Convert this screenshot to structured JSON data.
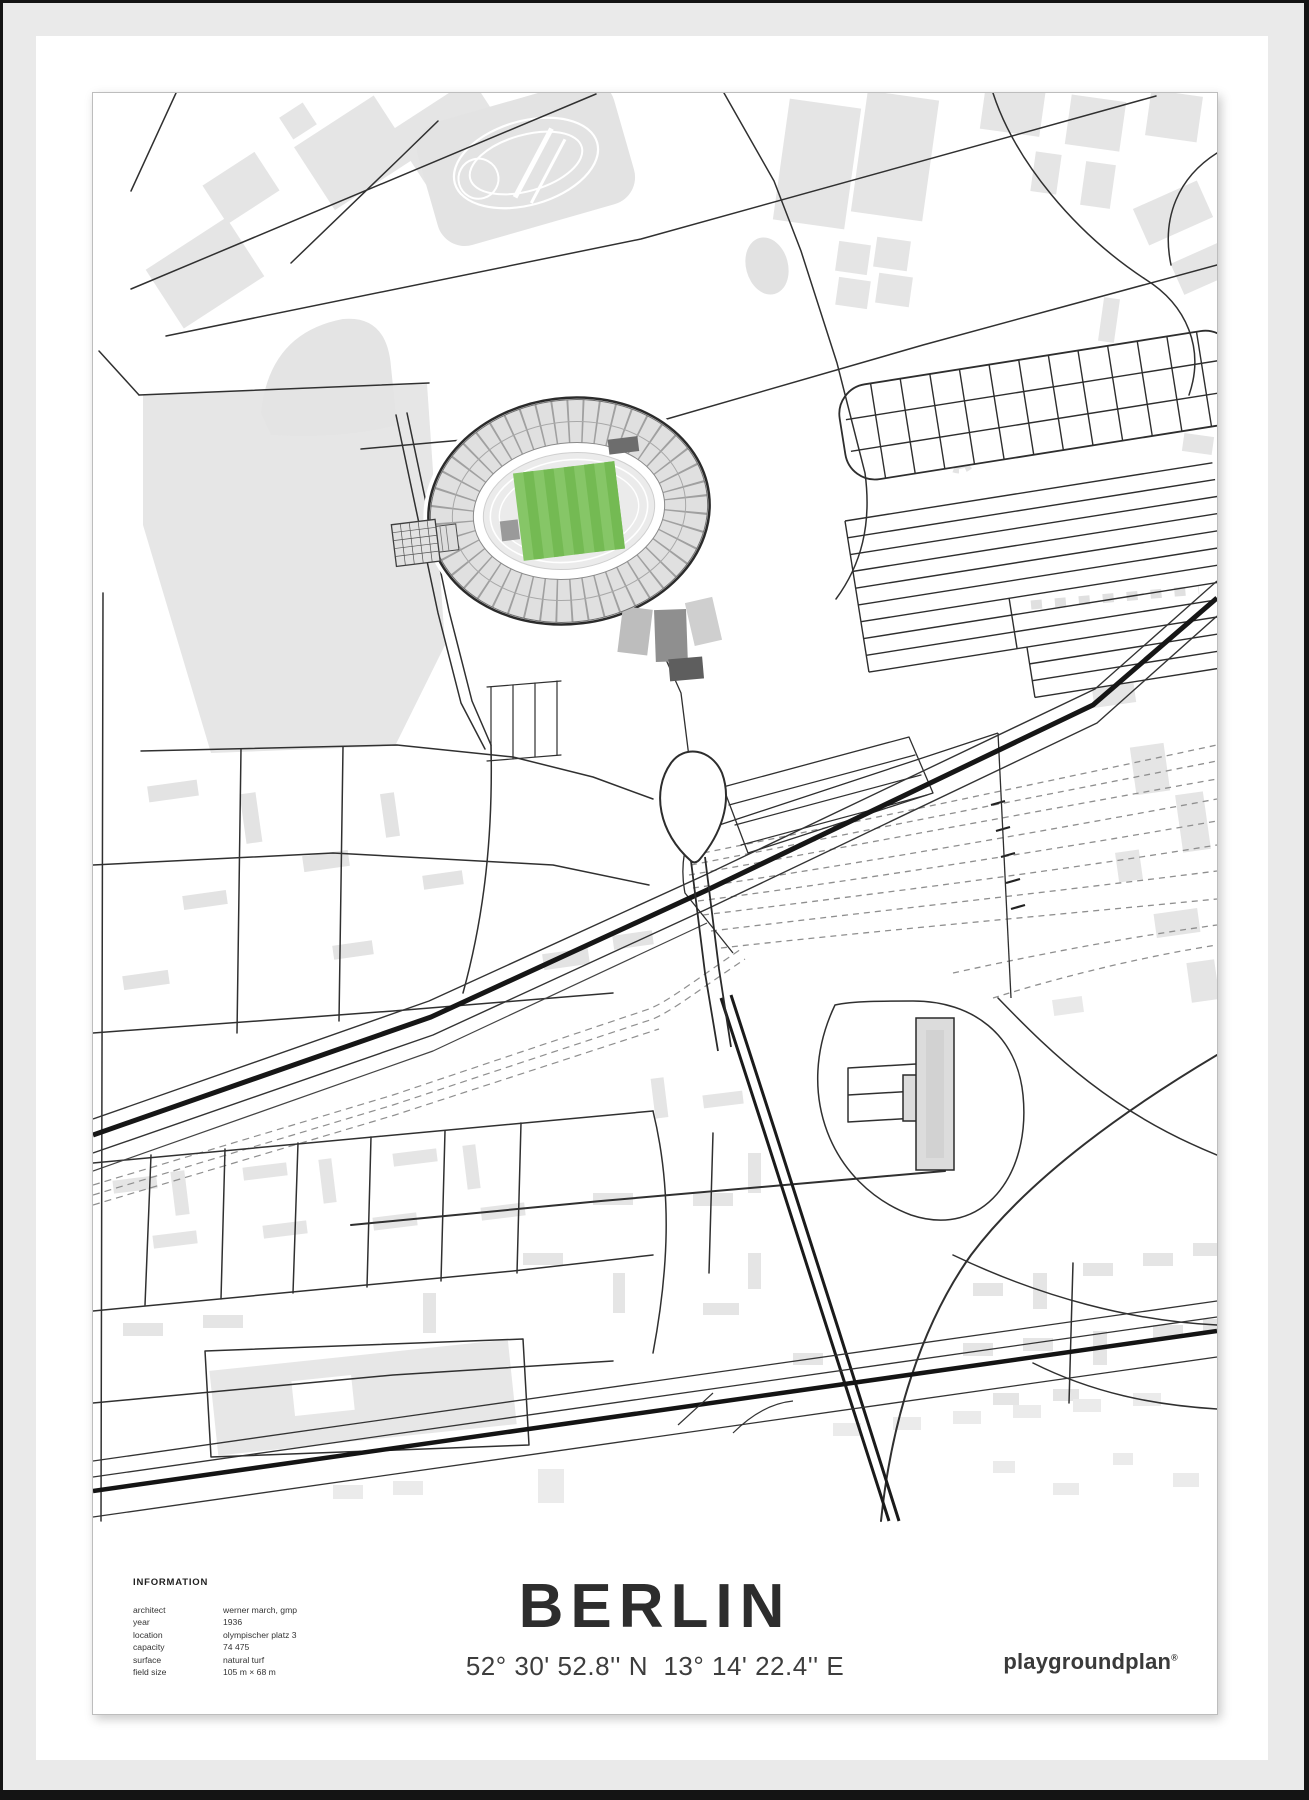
{
  "poster": {
    "title": "BERLIN",
    "coordinates": "52° 30' 52.8'' N  13° 14' 22.4'' E",
    "brand": "playgroundplan",
    "brand_mark": "®"
  },
  "information": {
    "heading": "INFORMATION",
    "rows": [
      {
        "label": "architect",
        "value": "werner march, gmp"
      },
      {
        "label": "year",
        "value": "1936"
      },
      {
        "label": "location",
        "value": "olympischer platz 3"
      },
      {
        "label": "capacity",
        "value": "74 475"
      },
      {
        "label": "surface",
        "value": "natural turf"
      },
      {
        "label": "field size",
        "value": "105 m × 68 m"
      }
    ]
  },
  "map": {
    "subject": "Olympiastadion Berlin street map",
    "pitch_color": "#86c667",
    "pitch_stripe_color": "#74ba53",
    "building_color": "#e5e5e5",
    "road_color": "#2e2e2e"
  }
}
